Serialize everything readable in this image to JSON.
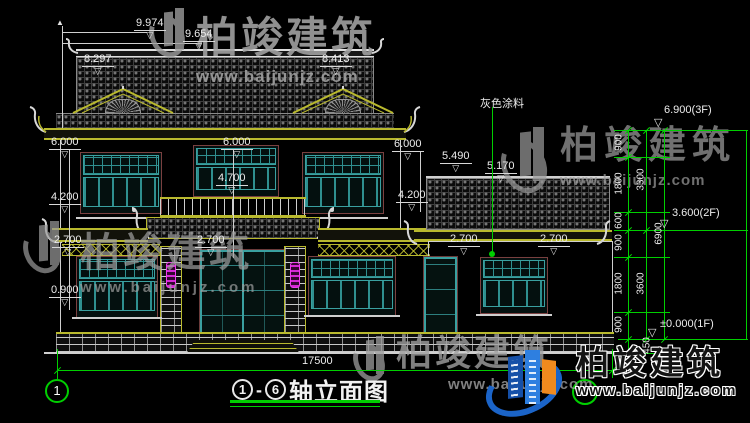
{
  "watermark": {
    "brand": "柏竣建筑",
    "url": "www.baijunjz.com"
  },
  "logo": {
    "brand": "柏竣建筑",
    "url": "www.baijunjz.com"
  },
  "title": {
    "axis_from": "1",
    "dash": "-",
    "axis_to": "6",
    "text": "轴立面图"
  },
  "axis": {
    "left_bubble": "1",
    "right_bubble": "6"
  },
  "symbols": {
    "level_marker": "▽",
    "arrow_up": "▲"
  },
  "labels": {
    "paint": "灰色涂料",
    "total_width": "17500"
  },
  "elevations": {
    "ridge_peak": "9.974",
    "ridge_upper": "9.654",
    "gable_left": "8.297",
    "gable_right": "8.413",
    "eave_left": "6.000",
    "eave_center": "6.000",
    "eave_right": "6.000",
    "balcony_rail": "4.700",
    "sill2_left": "4.200",
    "sill2_right": "4.200",
    "win1_top_left": "2.700",
    "win1_top_center": "2.700",
    "annex_win_top_a": "2.700",
    "annex_win_top_b": "2.700",
    "sill1": "0.900",
    "annex_roof_high": "5.490",
    "annex_roof_low": "5.170",
    "floor3": "6.900(3F)",
    "floor2": "3.600(2F)",
    "floor1": "±0.000(1F)"
  },
  "dim_chain": {
    "segments": [
      "900",
      "1800",
      "600",
      "900",
      "1800",
      "900"
    ],
    "subtotals": [
      "3300",
      "3600"
    ],
    "total": "6900",
    "plinth": "450"
  },
  "colors": {
    "dim_green": "#00cf00",
    "window_teal": "#3aa0a0",
    "eave_yellow": "#b9b92e",
    "lantern_magenta": "#e63ce6",
    "logo_blue": "#1b64c8",
    "logo_orange": "#f08a1e"
  }
}
